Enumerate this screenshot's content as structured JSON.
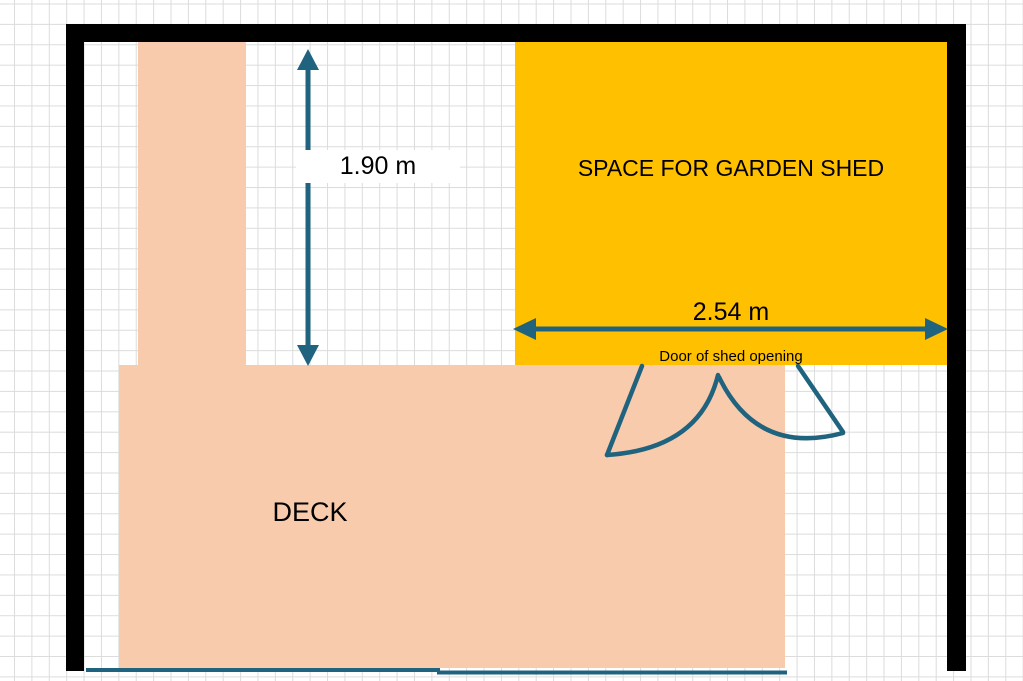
{
  "diagram": {
    "title": "garden-plan",
    "shed": {
      "label": "SPACE FOR GARDEN SHED",
      "width_dimension": "2.54 m",
      "fill_color": "#FFC000"
    },
    "deck": {
      "label": "DECK",
      "fill_color": "#F8CBAD"
    },
    "door": {
      "label": "Door of shed opening"
    },
    "clearance": {
      "vertical_dimension": "1.90 m"
    },
    "colors": {
      "wall": "#000000",
      "annotation": "#20637E",
      "grid_line": "#DCDCDC",
      "background": "#FFFFFF",
      "text": "#000000"
    }
  }
}
